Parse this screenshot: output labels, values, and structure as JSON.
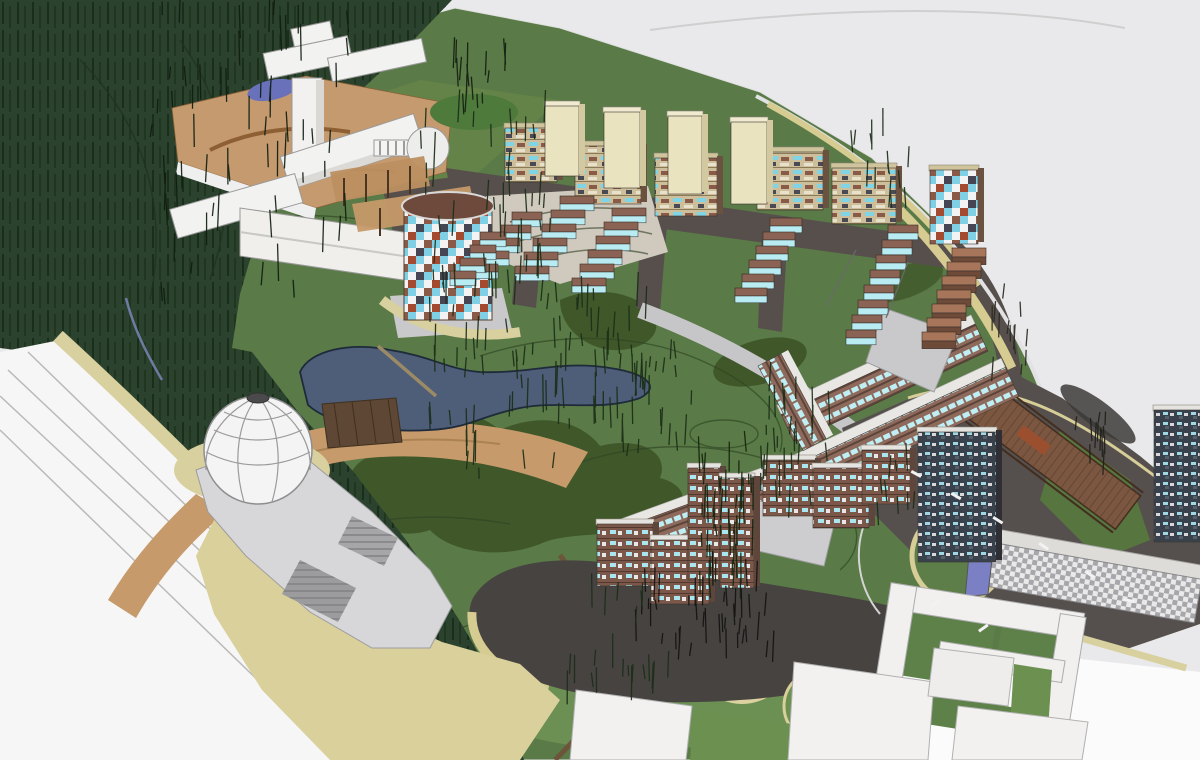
{
  "meta": {
    "scene_type": "aerial 3d masterplan massing rendering",
    "labels": {
      "forest": "wooded-hillside",
      "park": "central-park",
      "pond": "pond",
      "dome": "geodesic-dome-pavilion",
      "cylinder": "cylindrical-mosaic-tower",
      "plaza": "charcoal-event-plaza",
      "boardwalk": "timber-boardwalk",
      "slab": "long-checkered-slab-building"
    }
  },
  "palette": {
    "bg": "#e9e9eb",
    "bg_light": "#f4f4f5",
    "road_zone": "#f6f6f7",
    "park": "#5a7a47",
    "park_light": "#6e9155",
    "hill_light": "#668549",
    "shadow_green": "#3c5226",
    "shadow_green2": "#42592c",
    "forest": "#2b422e",
    "sidewalk_tan": "#d8d09e",
    "path_tan": "#d6cc92",
    "plaza_tan": "#d9d09c",
    "tan_circle": "#dbd2a0",
    "ochre": "#c69a6a",
    "ochre_deck": "#c49a6e",
    "pergola": "#bd8f60",
    "pond": "#4e5d78",
    "pond_small": "#6a71bb",
    "deck_brown": "#5e4734",
    "street_dark": "#574f4c",
    "charcoal": "#474341",
    "asphalt": "#55504e",
    "road_gray": "#c6c6c8",
    "plinth_gray": "#c9c9cb",
    "deck_gray": "#cdcdcf",
    "platform": "#d7d7d9",
    "platform_sunken": "#9c9c9f",
    "dome_white": "#f4f4f4",
    "dome_hole": "#4a4a4c",
    "white_bldg": "#f2f1ef",
    "white_shade": "#d9d8d4",
    "cream": "#eae3c0",
    "cream_side": "#d2c9a0",
    "roof_tan": "#cfc49c",
    "roof_light": "#e6e4e0",
    "roof_white": "#dddcd8",
    "cyl_roof": "#6e4a3d",
    "swirl_plaza": "#d0cabe",
    "step_top": "#8a6354",
    "step_glass": "#b8ecf2",
    "brick_top": "#a7765a",
    "brick_front": "#6e4a38",
    "island_green": "#5e7e49",
    "patch_green": "#6c9553",
    "court_green": "#5e8149",
    "strip_green": "#6c9050",
    "boardwalk": "#7b5741",
    "bench_red": "#9c4f2e",
    "blue_wall": "#7b80c4",
    "white_ground": "#fbfbfc",
    "grove_green": "#4e7a3c",
    "wedge_green": "#57763f"
  },
  "scene": {
    "tree_clusters": [
      {
        "x": 150,
        "y": 15,
        "w": 200,
        "h": 290,
        "n": 60,
        "c": "#101e10",
        "l": 30
      },
      {
        "x": 420,
        "y": 120,
        "w": 130,
        "h": 170,
        "n": 36,
        "c": "#1c2e18",
        "l": 26
      },
      {
        "x": 430,
        "y": 270,
        "w": 140,
        "h": 210,
        "n": 60,
        "c": "#1c2e18",
        "l": 30
      },
      {
        "x": 560,
        "y": 300,
        "w": 90,
        "h": 150,
        "n": 30,
        "c": "#1c2e18",
        "l": 28
      },
      {
        "x": 620,
        "y": 350,
        "w": 80,
        "h": 110,
        "n": 22,
        "c": "#1c2e18",
        "l": 24
      },
      {
        "x": 696,
        "y": 450,
        "w": 58,
        "h": 150,
        "n": 45,
        "c": "#16240f",
        "l": 30
      },
      {
        "x": 760,
        "y": 390,
        "w": 70,
        "h": 130,
        "n": 28,
        "c": "#1c2e18",
        "l": 26
      },
      {
        "x": 636,
        "y": 584,
        "w": 140,
        "h": 78,
        "n": 40,
        "c": "#141414",
        "l": 26
      },
      {
        "x": 560,
        "y": 600,
        "w": 110,
        "h": 110,
        "n": 22,
        "c": "#1c2e18",
        "l": 26
      },
      {
        "x": 452,
        "y": 58,
        "w": 54,
        "h": 58,
        "n": 16,
        "c": "#151f12",
        "l": 26
      },
      {
        "x": 985,
        "y": 292,
        "w": 44,
        "h": 90,
        "n": 14,
        "c": "#2a2a22",
        "l": 22
      },
      {
        "x": 848,
        "y": 134,
        "w": 60,
        "h": 76,
        "n": 14,
        "c": "#1c2e18",
        "l": 22
      },
      {
        "x": 1066,
        "y": 420,
        "w": 44,
        "h": 64,
        "n": 12,
        "c": "#20201a",
        "l": 20
      },
      {
        "x": 878,
        "y": 470,
        "w": 40,
        "h": 60,
        "n": 10,
        "c": "#1c2e18",
        "l": 18
      }
    ],
    "cascades": [
      {
        "x": 512,
        "y": 212,
        "n": 5,
        "dx": -11,
        "dy": 13,
        "w": 30,
        "h": 8,
        "k": "glass"
      },
      {
        "x": 560,
        "y": 196,
        "n": 6,
        "dx": -9,
        "dy": 14,
        "w": 34,
        "h": 8,
        "k": "glass"
      },
      {
        "x": 612,
        "y": 208,
        "n": 6,
        "dx": -8,
        "dy": 14,
        "w": 34,
        "h": 8,
        "k": "glass"
      },
      {
        "x": 770,
        "y": 218,
        "n": 6,
        "dx": -7,
        "dy": 14,
        "w": 32,
        "h": 8,
        "k": "glass"
      },
      {
        "x": 888,
        "y": 225,
        "n": 8,
        "dx": -6,
        "dy": 15,
        "w": 30,
        "h": 8,
        "k": "glass"
      },
      {
        "x": 952,
        "y": 248,
        "n": 7,
        "dx": -5,
        "dy": 14,
        "w": 34,
        "h": 9,
        "k": "brick"
      },
      {
        "x": 480,
        "y": 232,
        "n": 4,
        "dx": -10,
        "dy": 13,
        "w": 26,
        "h": 8,
        "k": "glass"
      }
    ],
    "blocks": [
      {
        "x": 505,
        "y": 128,
        "w": 52,
        "h": 54,
        "k": "busy"
      },
      {
        "x": 575,
        "y": 146,
        "w": 66,
        "h": 58,
        "k": "busy"
      },
      {
        "x": 655,
        "y": 158,
        "w": 62,
        "h": 58,
        "k": "busy"
      },
      {
        "x": 757,
        "y": 152,
        "w": 66,
        "h": 58,
        "k": "busy"
      },
      {
        "x": 832,
        "y": 168,
        "w": 64,
        "h": 56,
        "k": "busy"
      },
      {
        "x": 545,
        "y": 106,
        "w": 34,
        "h": 70,
        "k": "cream"
      },
      {
        "x": 604,
        "y": 112,
        "w": 36,
        "h": 76,
        "k": "cream"
      },
      {
        "x": 668,
        "y": 116,
        "w": 34,
        "h": 78,
        "k": "cream"
      },
      {
        "x": 731,
        "y": 122,
        "w": 36,
        "h": 82,
        "k": "cream"
      },
      {
        "x": 930,
        "y": 170,
        "w": 48,
        "h": 74,
        "k": "mosaic"
      },
      {
        "x": 597,
        "y": 524,
        "w": 56,
        "h": 62,
        "k": "win"
      },
      {
        "x": 651,
        "y": 540,
        "w": 58,
        "h": 64,
        "k": "win"
      },
      {
        "x": 763,
        "y": 460,
        "w": 52,
        "h": 56,
        "k": "win"
      },
      {
        "x": 813,
        "y": 468,
        "w": 56,
        "h": 60,
        "k": "win"
      },
      {
        "x": 862,
        "y": 450,
        "w": 48,
        "h": 54,
        "k": "win"
      },
      {
        "x": 688,
        "y": 468,
        "w": 32,
        "h": 112,
        "k": "win"
      },
      {
        "x": 720,
        "y": 478,
        "w": 34,
        "h": 110,
        "k": "win"
      },
      {
        "x": 918,
        "y": 432,
        "w": 78,
        "h": 130,
        "k": "dark"
      },
      {
        "x": 1154,
        "y": 410,
        "w": 46,
        "h": 132,
        "k": "dark"
      }
    ],
    "dashes": [
      {
        "x": 912,
        "y": 470,
        "a": 28
      },
      {
        "x": 952,
        "y": 492,
        "a": 30
      },
      {
        "x": 994,
        "y": 516,
        "a": 32
      },
      {
        "x": 1040,
        "y": 542,
        "a": 34
      },
      {
        "x": 1086,
        "y": 570,
        "a": 34
      },
      {
        "x": 930,
        "y": 606,
        "a": -40
      },
      {
        "x": 978,
        "y": 630,
        "a": -35
      },
      {
        "x": 1124,
        "y": 598,
        "a": 12
      }
    ]
  }
}
